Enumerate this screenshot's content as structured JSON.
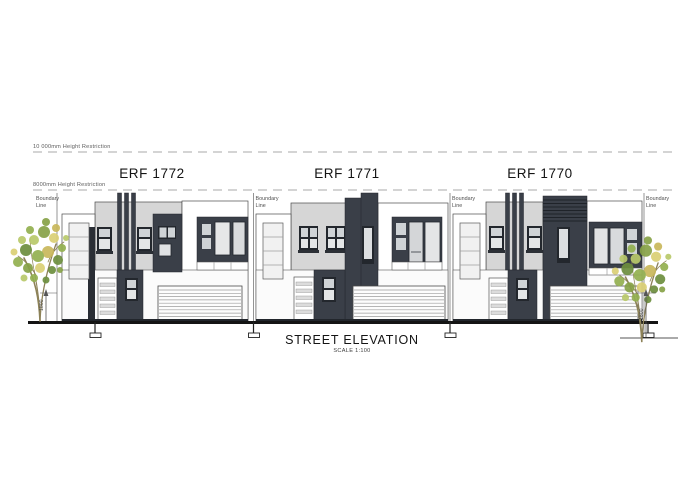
{
  "title": {
    "main": "STREET ELEVATION",
    "scale": "SCALE 1:100"
  },
  "units": [
    {
      "id": "erf-1772",
      "label": "ERF 1772"
    },
    {
      "id": "erf-1771",
      "label": "ERF 1771"
    },
    {
      "id": "erf-1770",
      "label": "ERF 1770"
    }
  ],
  "annotations": {
    "height_restriction_upper": "10 000mm Height Restriction",
    "height_restriction_lower": "8000mm Height Restriction",
    "boundary_label_line1": "Boundary",
    "boundary_label_line2": "Line",
    "fence_height_dim": "1800"
  },
  "drawing": {
    "type": "architectural-street-elevation",
    "units_count": 3,
    "boundary_lines_count": 4,
    "trees_count": 2
  },
  "colors": {
    "charcoal_cladding": "#3a3f48",
    "light_grey_wall": "#d6d6d6",
    "white_wall": "#ffffff",
    "outline": "#4a4a4a",
    "ground_line": "#141414",
    "foliage_palette": [
      "#6d8f3e",
      "#93b050",
      "#b9c96b",
      "#dbd075",
      "#87a247",
      "#c9b85c"
    ],
    "tree_trunk": "#8d8258"
  }
}
